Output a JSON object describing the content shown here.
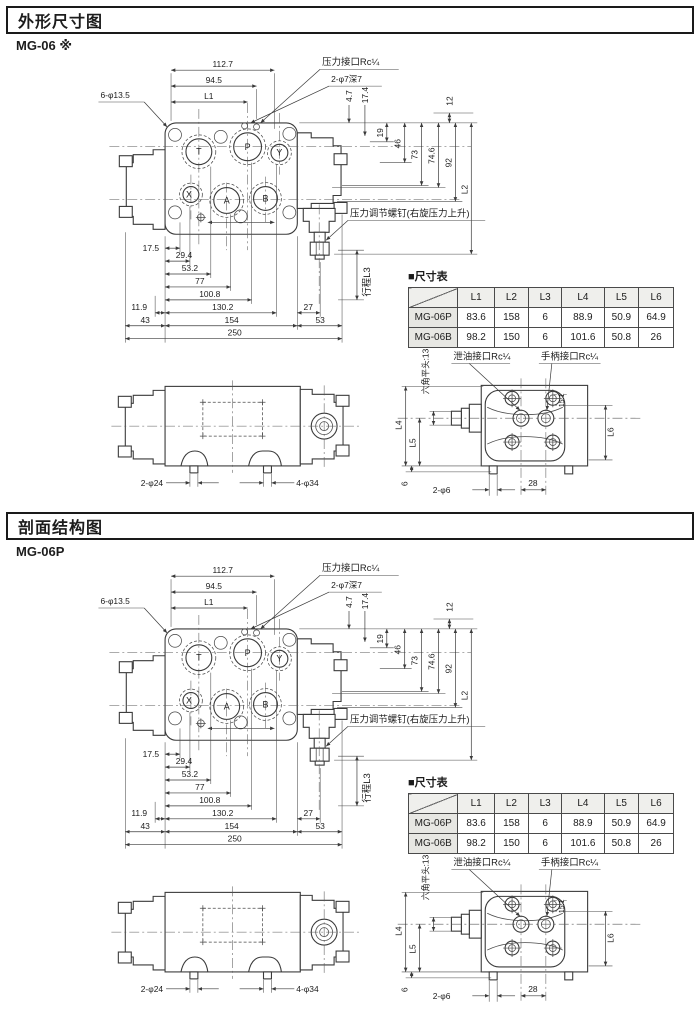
{
  "page": {
    "bg": "#ffffff"
  },
  "sections": [
    {
      "header": "外形尺寸图",
      "model": "MG-06 ※"
    },
    {
      "header": "剖面结构图",
      "model": "MG-06P"
    }
  ],
  "drawing": {
    "top": {
      "d112_7": "112.7",
      "d94_5": "94.5",
      "L1": "L1",
      "bolts": "6-φ13.5",
      "pressure_port": "压力接口Rc¼",
      "holes": "2-φ7深7",
      "d4_7": "4.7",
      "d17_4": "17.4",
      "d12": "12",
      "d19": "19",
      "d46": "46",
      "d73": "73",
      "d74_6": "74.6",
      "d92": "92",
      "L2": "L2",
      "adjust_screw": "压力调节螺钉(右旋压力上升)",
      "stroke": "行程L3",
      "d17_5": "17.5",
      "d29_4": "29.4",
      "d53_2": "53.2",
      "d77": "77",
      "d100_8": "100.8",
      "d11_9": "11.9",
      "d130_2": "130.2",
      "d27": "27",
      "d43": "43",
      "d154": "154",
      "d53": "53",
      "d250": "250",
      "ports": {
        "T": "T",
        "P": "P",
        "Y": "Y",
        "X": "X",
        "A": "A",
        "B": "B"
      }
    },
    "side": {
      "d2_24": "2-φ24",
      "d4_34": "4-φ34"
    },
    "end": {
      "hex": "六角平头:13",
      "drain_port": "泄油接口Rc¼",
      "handle_port": "手柄接口Rc¼",
      "L4": "L4",
      "L5": "L5",
      "L6": "L6",
      "d6": "6",
      "d2_6": "2-φ6",
      "d28": "28",
      "d15_1": "15.1"
    }
  },
  "table": {
    "title": "■尺寸表",
    "headers": [
      "L1",
      "L2",
      "L3",
      "L4",
      "L5",
      "L6"
    ],
    "rows": [
      {
        "model": "MG-06P",
        "values": [
          "83.6",
          "158",
          "6",
          "88.9",
          "50.9",
          "64.9"
        ]
      },
      {
        "model": "MG-06B",
        "values": [
          "98.2",
          "150",
          "6",
          "101.6",
          "50.8",
          "26"
        ]
      }
    ]
  }
}
